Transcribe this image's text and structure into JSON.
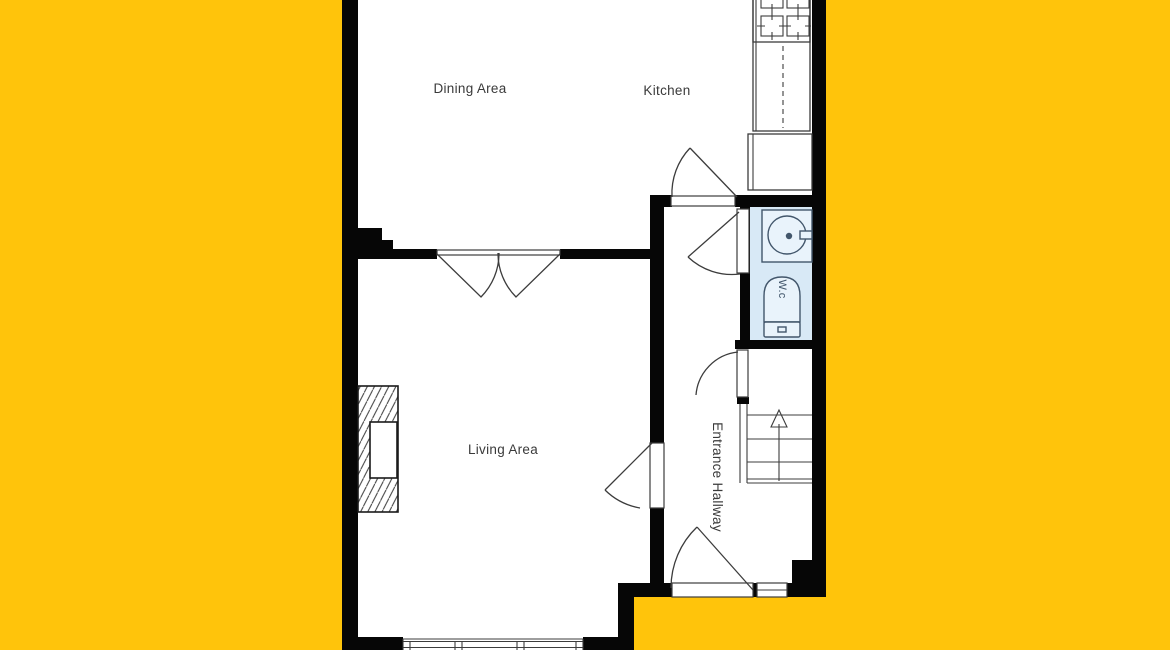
{
  "title": "Ground floor plan",
  "colors": {
    "background": "#FFC40B",
    "wall": "#060606",
    "floor": "#FFFFFF",
    "wc_floor": "#D8E9F6",
    "line": "#3C3C3C"
  },
  "rooms": {
    "dining": {
      "label": "Dining Area"
    },
    "kitchen": {
      "label": "Kitchen"
    },
    "living": {
      "label": "Living Area"
    },
    "hallway": {
      "label": "Entrance Hallway"
    },
    "wc": {
      "label": "W.c"
    }
  }
}
